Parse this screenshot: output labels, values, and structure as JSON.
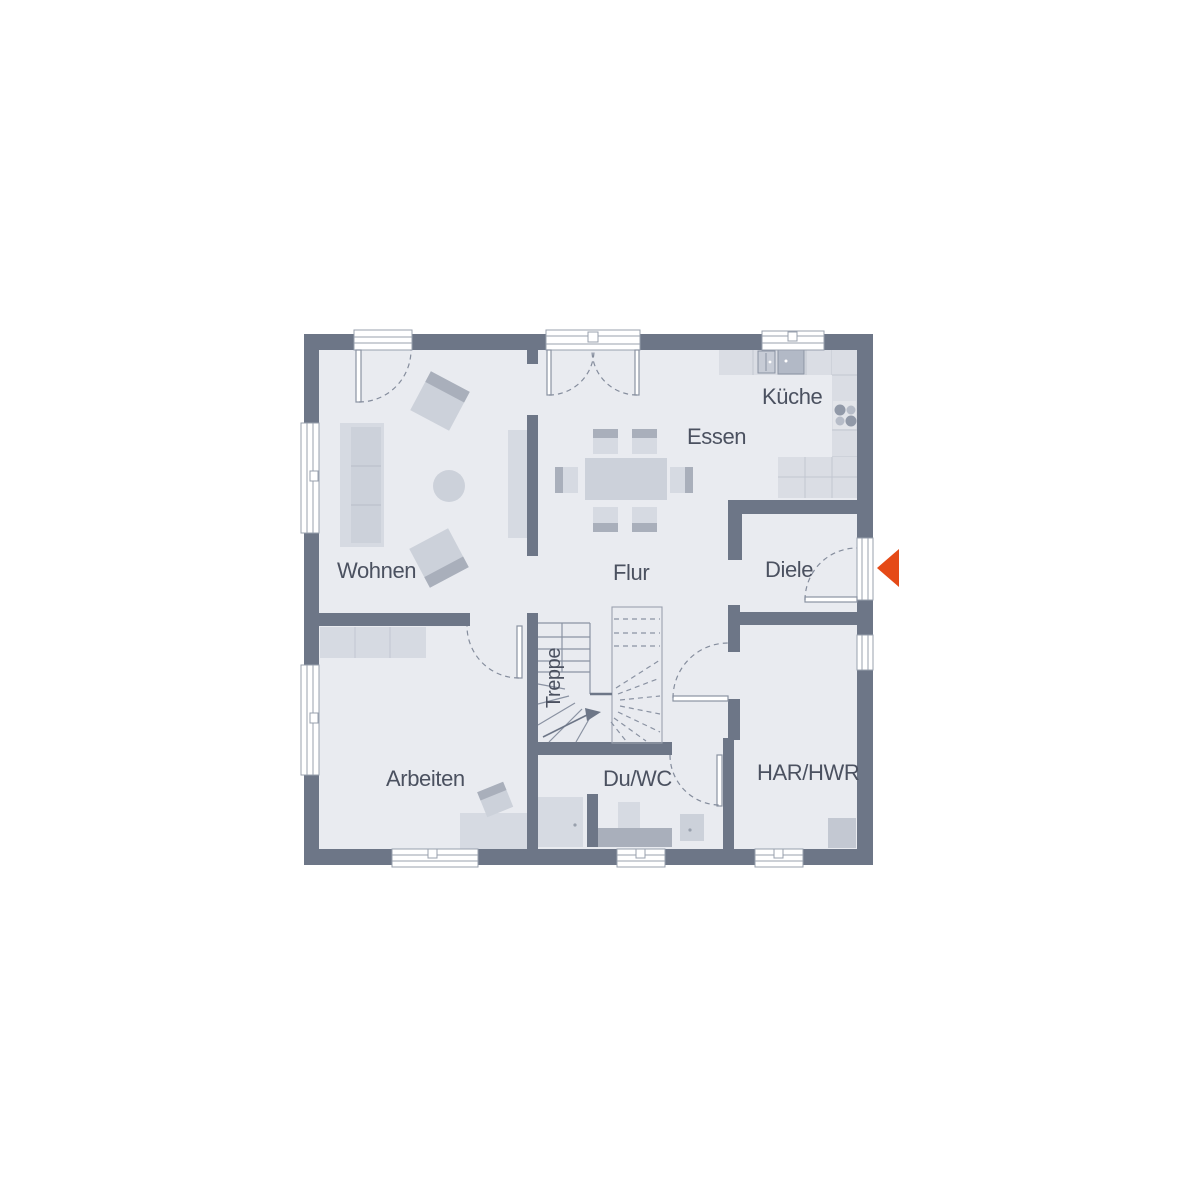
{
  "rooms": {
    "wohnen": {
      "label": "Wohnen"
    },
    "essen": {
      "label": "Essen"
    },
    "kueche": {
      "label": "Küche"
    },
    "flur": {
      "label": "Flur"
    },
    "diele": {
      "label": "Diele"
    },
    "arbeiten": {
      "label": "Arbeiten"
    },
    "duwc": {
      "label": "Du/WC"
    },
    "harhwr": {
      "label": "HAR/HWR"
    },
    "treppe": {
      "label": "Treppe"
    }
  },
  "symbols": {
    "entrance_arrow": "entrance-direction-marker"
  },
  "colors": {
    "wall": "#6d7687",
    "floor": "#e9ebf0",
    "furniture_light": "#d6dae2",
    "furniture_mid": "#ccd1da",
    "furniture_dark": "#a9afbb",
    "window_frame": "#98a0ae",
    "accent": "#e54a17",
    "label_text": "#4b5160",
    "background": "#ffffff"
  }
}
